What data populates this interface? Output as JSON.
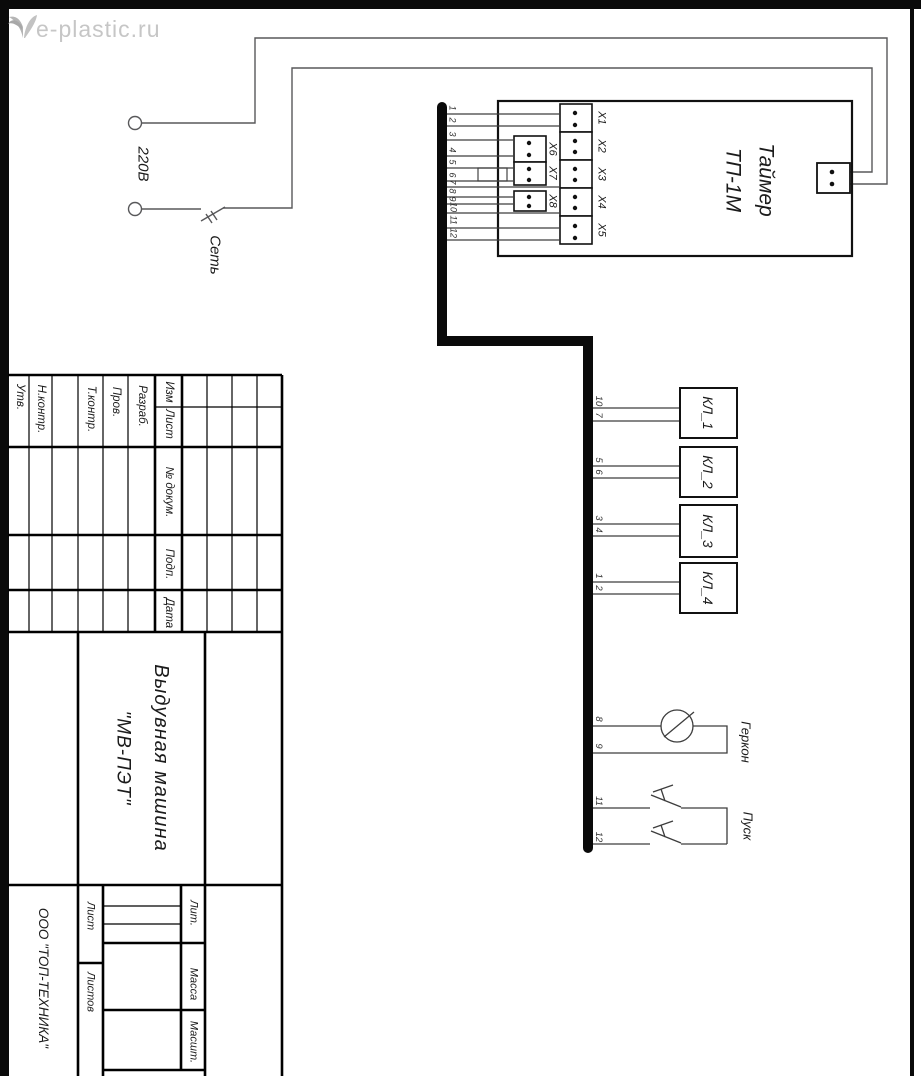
{
  "watermark": {
    "text": "e-plastic.ru"
  },
  "power": {
    "voltage": "220В",
    "switch": "Сеть"
  },
  "timer": {
    "name_line1": "Таймер",
    "name_line2": "ТП-1М",
    "right_connectors": [
      "Х1",
      "Х2",
      "Х3",
      "Х4",
      "Х5"
    ],
    "left_connectors": [
      "Х6",
      "Х7",
      "Х8"
    ]
  },
  "bus": {
    "wire_numbers": [
      "1",
      "2",
      "3",
      "4",
      "5",
      "6",
      "7",
      "8",
      "9",
      "10",
      "11",
      "12"
    ]
  },
  "valves": [
    {
      "label": "КЛ_1",
      "wire_top": "10",
      "wire_bottom": "7"
    },
    {
      "label": "КЛ_2",
      "wire_top": "5",
      "wire_bottom": "6"
    },
    {
      "label": "КЛ_3",
      "wire_top": "3",
      "wire_bottom": "4"
    },
    {
      "label": "КЛ_4",
      "wire_top": "1",
      "wire_bottom": "2"
    }
  ],
  "reed": {
    "label": "Геркон",
    "wire_top": "8",
    "wire_bottom": "9"
  },
  "start": {
    "label": "Пуск",
    "wire_top": "11",
    "wire_bottom": "12"
  },
  "title_block": {
    "cols": {
      "izm": "Изм",
      "list": "Лист",
      "dokum": "№ докум.",
      "podp": "Подп.",
      "data": "Дата"
    },
    "signers": {
      "razrab": "Разраб.",
      "prov": "Пров.",
      "tkontr": "Т.контр.",
      "nkontr": "Н.контр.",
      "utv": "Утв."
    },
    "product_line1": "Выдувная  машина",
    "product_line2": "\"МВ-ПЭТ\"",
    "company": "ООО \"ТОП-ТЕХНИКА\"",
    "lit": "Лит.",
    "massa": "Масса",
    "masshtab": "Масшт.",
    "sheet": "Лист",
    "sheets": "Листов"
  },
  "colors": {
    "line": "#3d3d3d",
    "power_line": "#58585a",
    "bus": "#0a0a0a",
    "watermark": "#c6c6c6"
  }
}
